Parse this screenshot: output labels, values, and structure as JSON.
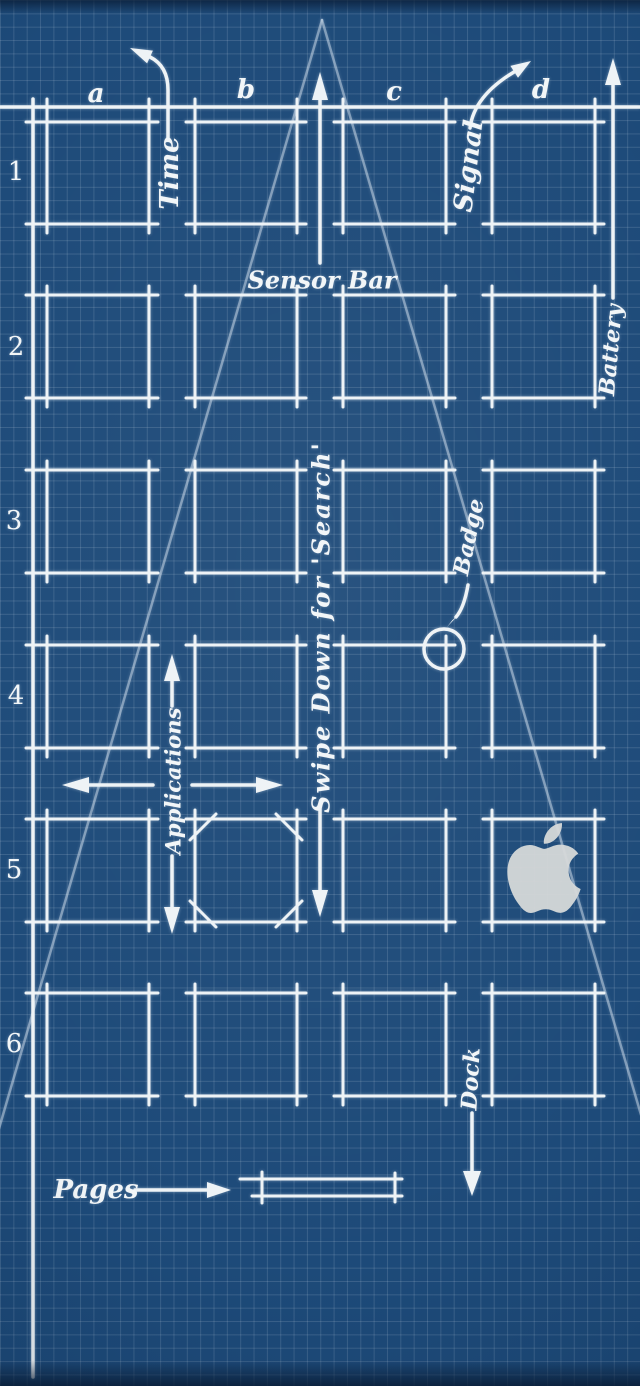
{
  "wallpaper": {
    "description": "Blueprint-style phone home screen schematic wallpaper",
    "colors": {
      "background": "#1d4a79",
      "grid_line": "#4f6a8d",
      "ink": "#eef3f6",
      "construction_line": "#d8e4f0",
      "apple_logo": "#d5d8d8"
    }
  },
  "labels": {
    "rows": [
      "1",
      "2",
      "3",
      "4",
      "5",
      "6"
    ],
    "columns": [
      "a",
      "b",
      "c",
      "d"
    ],
    "time": "Time",
    "sensor_bar": "Sensor Bar",
    "signal": "Signal",
    "battery": "Battery",
    "applications": "Applications",
    "swipe_search": "Swipe Down for 'Search'",
    "badge": "Badge",
    "dock": "Dock",
    "pages": "Pages"
  },
  "icons": {
    "apple": "apple-logo"
  },
  "geometry": {
    "canvas": {
      "w": 640,
      "h": 1386
    },
    "top_line": {
      "y": 107,
      "tick_xs": [
        47,
        149,
        195,
        297,
        343,
        446,
        492,
        595
      ]
    },
    "margin_line": {
      "x": 33,
      "y1": 99,
      "y2": 1377
    },
    "cols": [
      {
        "x": 47,
        "w": 102
      },
      {
        "x": 195,
        "w": 102
      },
      {
        "x": 343,
        "w": 103
      },
      {
        "x": 492,
        "w": 103
      }
    ],
    "rows": [
      {
        "y": 122,
        "h": 102
      },
      {
        "y": 295,
        "h": 103
      },
      {
        "y": 470,
        "h": 103
      },
      {
        "y": 645,
        "h": 103
      },
      {
        "y": 819,
        "h": 103
      },
      {
        "y": 993,
        "h": 103
      }
    ],
    "overshoot": 9,
    "triangle_legs": [
      "M322 20 L-2 1132",
      "M322 20 L646 1132"
    ],
    "squircle_marks": [
      "M216 814 L190 840",
      "M276 814 L302 840",
      "M190 901 L216 927",
      "M302 901 L276 927"
    ],
    "badge_circle": {
      "cx": 444,
      "cy": 649,
      "r": 20
    },
    "pages_bar": [
      "M240 1179 H402",
      "M252 1196 H402",
      "M262 1172 V1203",
      "M395 1173 V1202"
    ],
    "arrows": [
      {
        "name": "time-arrow",
        "path": "M168 140 V90 Q168 66 150 57",
        "head": "130,48 152.9,50.6 147.1,63.4"
      },
      {
        "name": "signal-arrow",
        "path": "M470 128 Q474 96 514 72",
        "head": "531,61 518,77.7 510.4,65.9"
      },
      {
        "name": "sensor-bar-arrow",
        "path": "M320 263 V98",
        "head": "320,72 312,100 328,100"
      },
      {
        "name": "battery-arrow",
        "path": "M613 298 V84",
        "head": "613,58 605,85 621,85"
      },
      {
        "name": "applications-arrow-up",
        "path": "M172 706 V679",
        "head": "172,654 164,681 180,681"
      },
      {
        "name": "applications-arrow-down",
        "path": "M172 856 V909",
        "head": "172,934 164,907 180,907"
      },
      {
        "name": "applications-arrow-left",
        "path": "M153 785 H87",
        "head": "62,785 89,777 89,793"
      },
      {
        "name": "applications-arrow-right",
        "path": "M192 785 H258",
        "head": "283,785 256,777 256,793"
      },
      {
        "name": "swipe-search-arrow",
        "path": "M320 808 V892",
        "head": "320,917 312,890 328,890"
      },
      {
        "name": "badge-arrow",
        "path": "M468 585 Q464 608 456 617",
        "head": "447,627 460.5,612.9 452.3,620.3"
      },
      {
        "name": "dock-arrow",
        "path": "M472 1113 V1174",
        "head": "472,1196 463,1171 481,1171"
      },
      {
        "name": "pages-arrow",
        "path": "M135 1190 H209",
        "head": "231,1190 207,1182 207,1198"
      }
    ]
  }
}
